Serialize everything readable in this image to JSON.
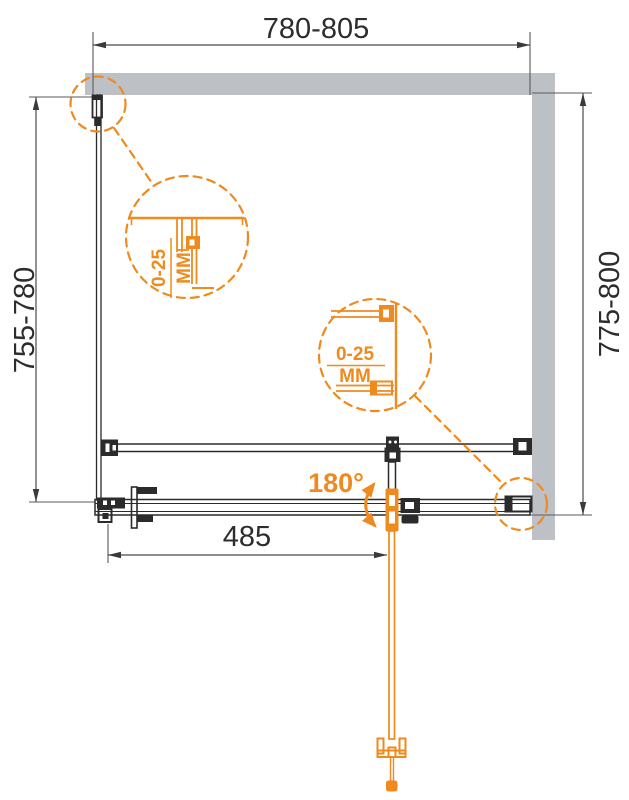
{
  "diagram": {
    "type": "shower-enclosure-installation-drawing",
    "dimensions": {
      "width_top": "780-805",
      "depth_left": "755-780",
      "depth_right": "775-800",
      "door_width": "485"
    },
    "rotation_angle": "180°",
    "details": {
      "top_left": {
        "range": "0-25",
        "unit": "MM"
      },
      "right": {
        "range": "0-25",
        "unit": "MM"
      }
    },
    "colors": {
      "accent_orange": "#EF8A1E",
      "wall_gray": "#BDC1C5",
      "line_dark": "#2B2B2B"
    }
  }
}
